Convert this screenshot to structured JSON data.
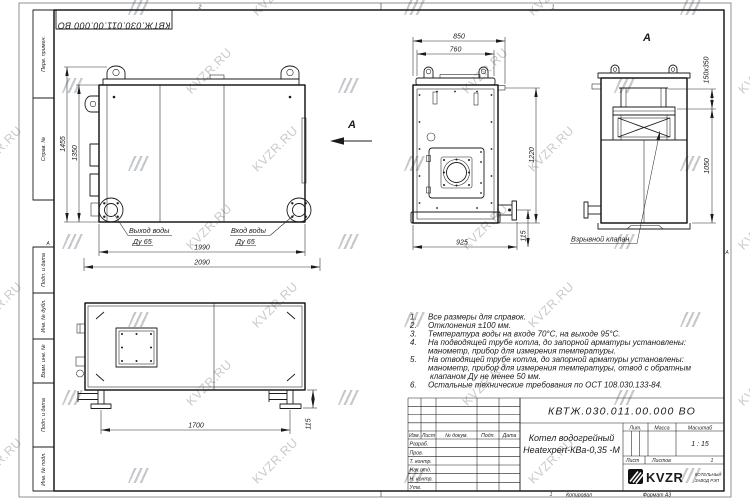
{
  "sheet": {
    "watermark_text": "KVZR.RU",
    "zones": {
      "top_left": "2",
      "top_right": "1",
      "bottom": "1",
      "left": "А",
      "right": "А"
    },
    "copied_label": "Копировал",
    "format_label": "Формат А3"
  },
  "margin": {
    "items": [
      "Перв. примен.",
      "Справ. №",
      "Подп. и дата",
      "Инв. № дубл.",
      "Взам. инв. №",
      "Подп. и дата",
      "Инв. № подл."
    ]
  },
  "title_block": {
    "designation": "КВТЖ.030.011.00.000 ВО",
    "product_name_line1": "Котел водогрейный",
    "product_name_line2": "Heatexpert-КВа-0,35 -М",
    "header": {
      "izm": "Изм.",
      "list": "Лист",
      "doc_no": "№ докум.",
      "podp": "Подп.",
      "data": "Дата"
    },
    "rows": {
      "razrab": "Разраб.",
      "prov": "Пров.",
      "t_kontr": "Т. контр.",
      "nach_otd": "Нач.отд.",
      "n_kontr": "Н. контр.",
      "utv": "Утв."
    },
    "lit_label": "Лит.",
    "massa_label": "Масса",
    "masshtab_label": "Масштаб",
    "scale_value": "1 : 15",
    "list_label": "Лист",
    "listov_label": "Листов",
    "listov_value": "1",
    "logo_text": "KVZR",
    "logo_sub1": "КОТЕЛЬНЫЙ",
    "logo_sub2": "ЗАВОД РЭП"
  },
  "views": {
    "side": {
      "dim_1455": "1455",
      "dim_1350": "1350",
      "dim_1990": "1990",
      "dim_2090": "2090",
      "outlet_line1": "Выход воды",
      "outlet_line2": "Ду 65",
      "inlet_line1": "Вход воды",
      "inlet_line2": "Ду 65",
      "arrow_label": "А"
    },
    "front": {
      "dim_850": "850",
      "dim_760": "760",
      "dim_1220": "1220",
      "dim_115": "115",
      "dim_925": "925"
    },
    "rear": {
      "view_title": "А",
      "dim_flue": "150х350",
      "dim_1050": "1050",
      "valve_label": "Взрывной клапан"
    },
    "plan": {
      "dim_1700": "1700",
      "dim_115": "115"
    }
  },
  "notes": [
    {
      "num": "1.",
      "lines": [
        "Все размеры для справок."
      ]
    },
    {
      "num": "2.",
      "lines": [
        "Отклонения ±100 мм."
      ]
    },
    {
      "num": "3.",
      "lines": [
        "Температура воды на входе 70°С, на выходе 95°С."
      ]
    },
    {
      "num": "4.",
      "lines": [
        "На подводящей трубе котла, до запорной арматуры установлены:",
        "манометр, прибор для измерения температуры."
      ]
    },
    {
      "num": "5.",
      "lines": [
        "На отводящей трубе котла, до запорной арматуры установлены:",
        "манометр, прибор для измерения температуры, отвод с обратным",
        "клапаном Ду не менее 50 мм."
      ]
    },
    {
      "num": "6.",
      "lines": [
        "Остальные технические требования по ОСТ 108.030.133-84."
      ]
    }
  ]
}
